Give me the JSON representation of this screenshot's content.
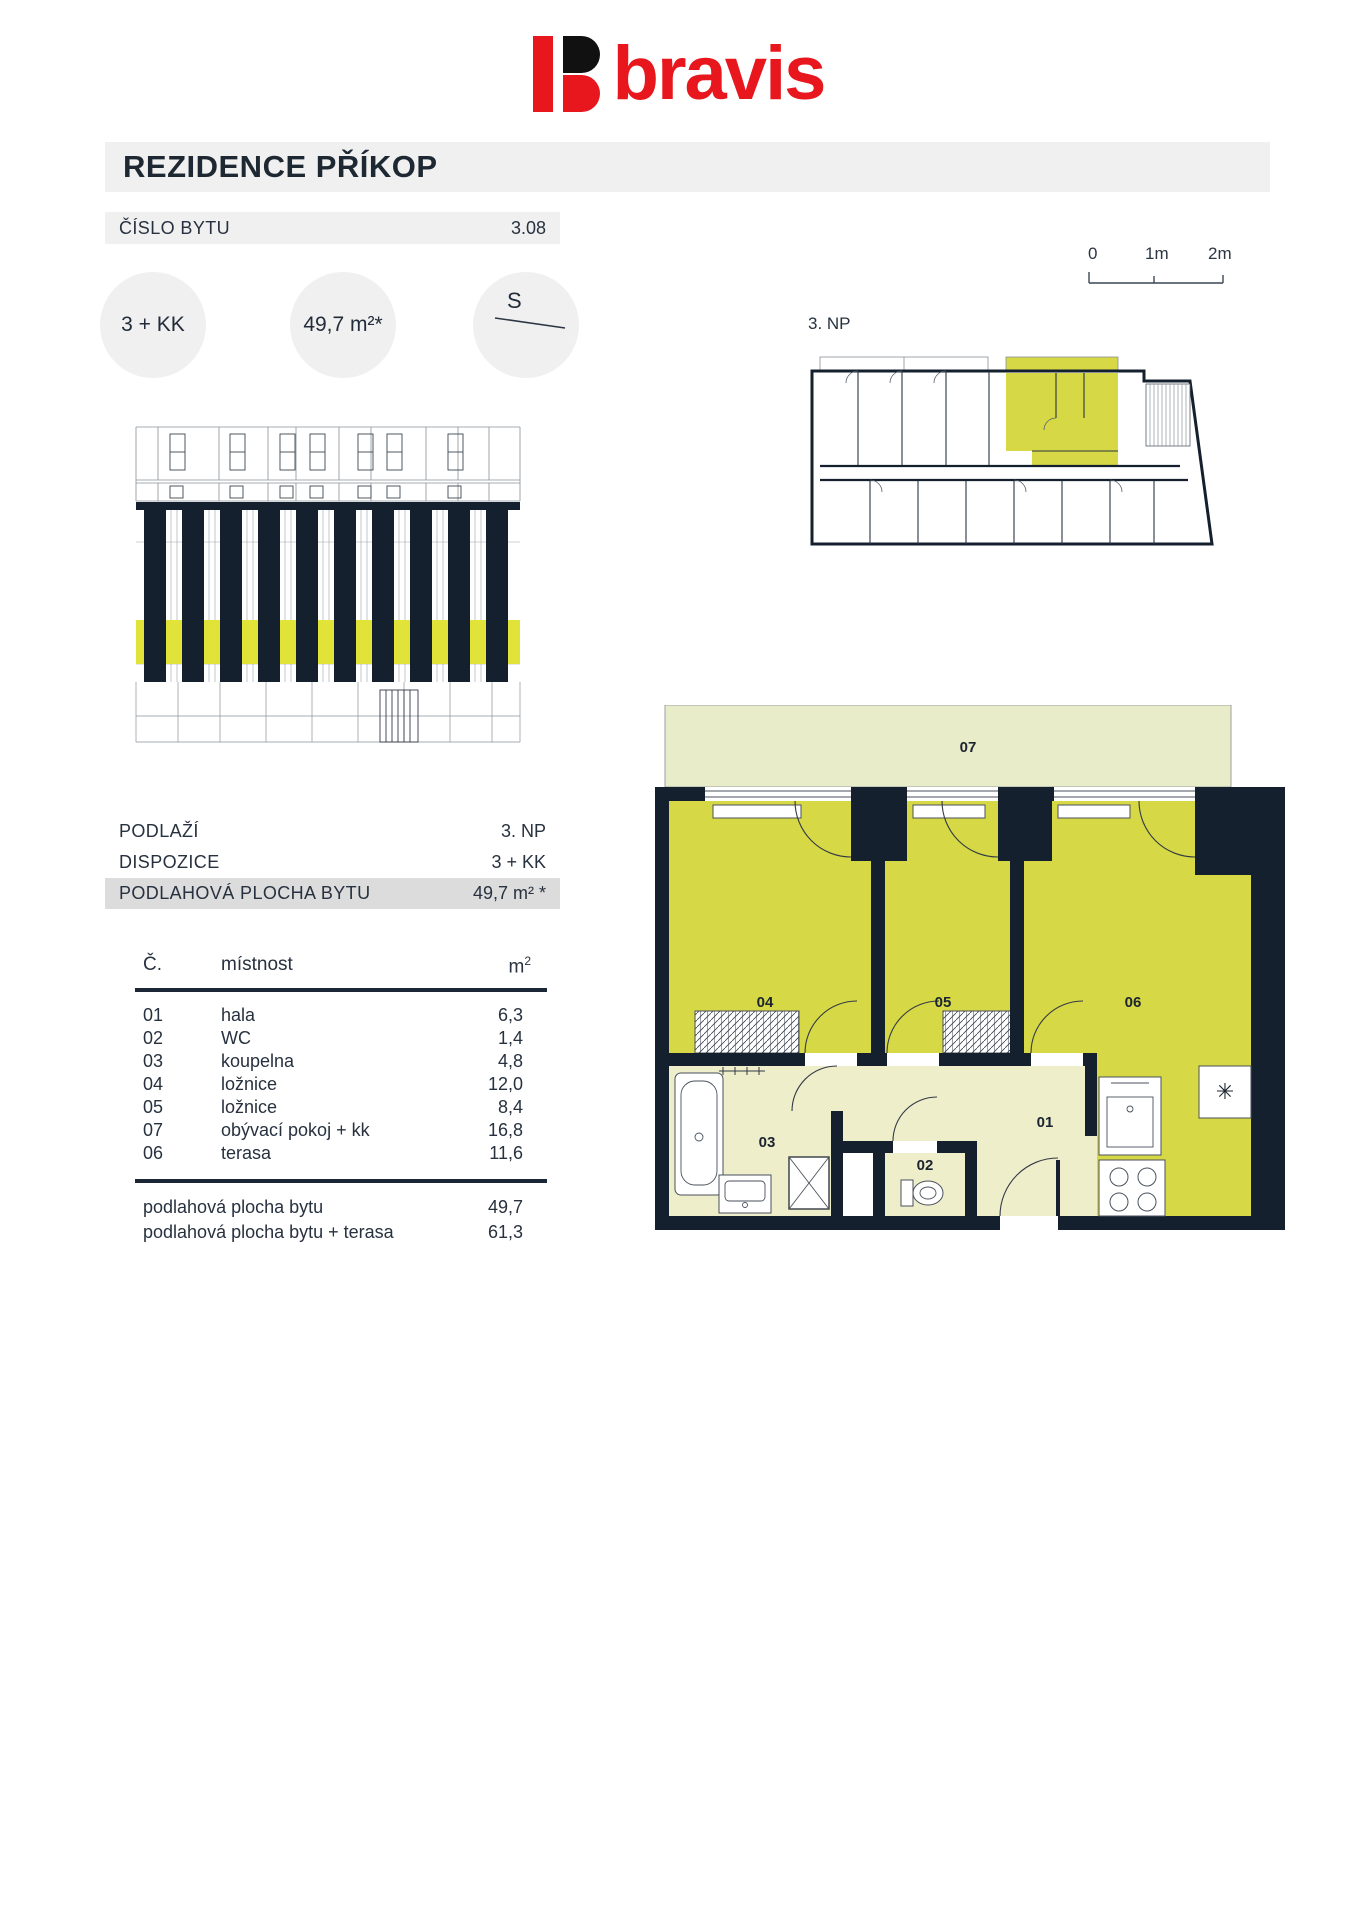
{
  "brand": {
    "name": "bravis",
    "color": "#e8161d"
  },
  "header": {
    "title": "REZIDENCE PŘÍKOP"
  },
  "unit_row": {
    "label": "ČÍSLO BYTU",
    "value": "3.08"
  },
  "badges": {
    "layout": "3 + KK",
    "area": "49,7 m²*",
    "compass": "S"
  },
  "overview": {
    "floor_label": "3. NP"
  },
  "scale_bar": {
    "ticks": [
      "0",
      "1m",
      "2m"
    ]
  },
  "summary": {
    "rows": [
      {
        "label": "PODLAŽÍ",
        "value": "3. NP"
      },
      {
        "label": "DISPOZICE",
        "value": "3 + KK"
      },
      {
        "label": "PODLAHOVÁ PLOCHA BYTU",
        "value": "49,7 m² *"
      }
    ]
  },
  "room_table": {
    "headers": {
      "num": "Č.",
      "name": "místnost",
      "area_base": "m",
      "area_sup": "2"
    },
    "rows": [
      {
        "num": "01",
        "name": "hala",
        "area": "6,3"
      },
      {
        "num": "02",
        "name": "WC",
        "area": "1,4"
      },
      {
        "num": "03",
        "name": "koupelna",
        "area": "4,8"
      },
      {
        "num": "04",
        "name": "ložnice",
        "area": "12,0"
      },
      {
        "num": "05",
        "name": "ložnice",
        "area": "8,4"
      },
      {
        "num": "07",
        "name": "obývací pokoj + kk",
        "area": "16,8"
      },
      {
        "num": "06",
        "name": "terasa",
        "area": "11,6"
      }
    ],
    "totals": [
      {
        "label": "podlahová plocha bytu",
        "value": "49,7"
      },
      {
        "label": "podlahová plocha bytu + terasa",
        "value": "61,3"
      }
    ]
  },
  "floor_plan": {
    "labels": {
      "terrace": "07",
      "bedroom_a": "04",
      "bedroom_b": "05",
      "living": "06",
      "hall": "01",
      "wc": "02",
      "bathroom": "03"
    }
  },
  "colors": {
    "brand_red": "#e8161d",
    "wall_dark": "#15202e",
    "unit_yellow": "#d6d945",
    "room_cream": "#eeeecb",
    "terrace_light": "#e9ecc8",
    "elevation_yellow": "#e2e338",
    "bar_gray": "#f0f0f0",
    "table_gray": "#dcdcdc"
  }
}
